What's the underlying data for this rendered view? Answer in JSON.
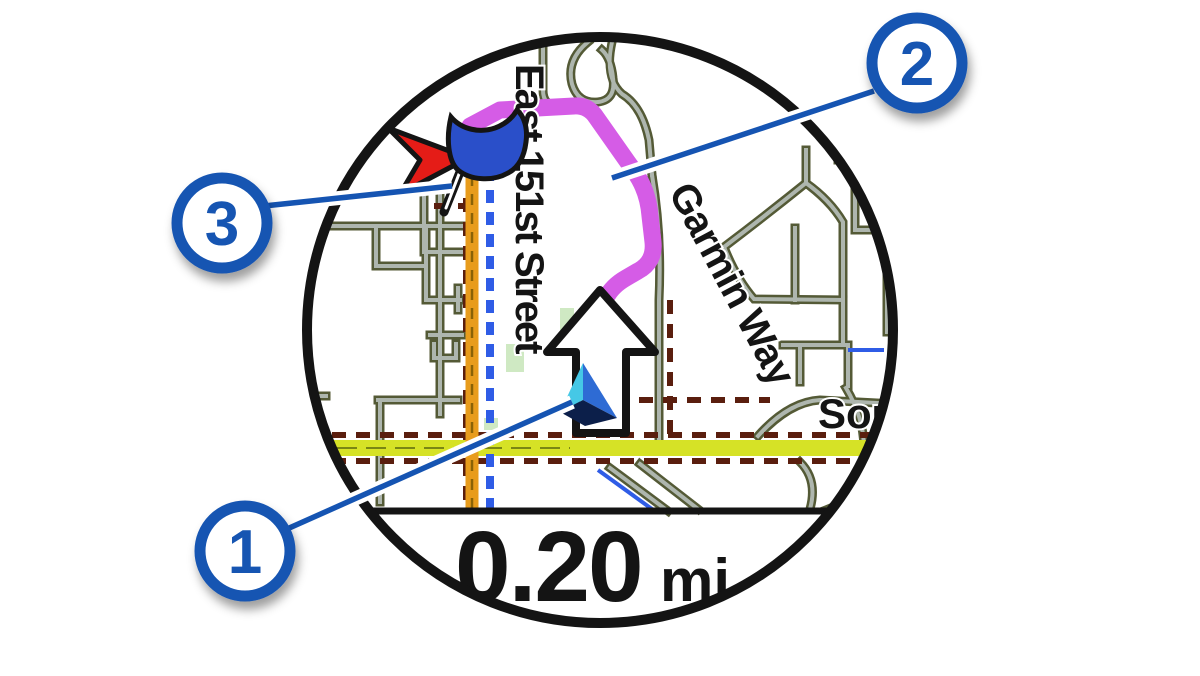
{
  "figure": {
    "type": "watch-navigation-map-callout-diagram",
    "description": "Round watch screen showing turn-by-turn map navigation with three numbered callouts"
  },
  "map": {
    "street_labels": {
      "vertical": "East 151st Street",
      "diagonal": "Garmin Way",
      "partial_right": "Sout"
    },
    "scale": {
      "value": "0.20",
      "unit": "mi"
    }
  },
  "callouts": [
    {
      "number": "1",
      "target": "current-position-marker"
    },
    {
      "number": "2",
      "target": "route-line"
    },
    {
      "number": "3",
      "target": "destination-marker"
    }
  ],
  "icons": {
    "c1_target": "position-triangle-icon",
    "c2_target": "route-magenta-line",
    "c3_target": "destination-flag-icon",
    "nav_arrow": "straight-ahead-arrow-icon",
    "pointer": "red-direction-arrow-icon"
  },
  "colors": {
    "callout_blue": "#1554b2",
    "route_magenta": "#d55ce6",
    "highway_orange": "#e89c1c",
    "road_yellow": "#d6e226",
    "road_casing_olive": "#545a36",
    "road_fill_gray": "#aeb6ae",
    "dash_maroon": "#5a1e0e",
    "track_blue": "#2f5ce6",
    "destination_red": "#e51c17",
    "flag_blue": "#2a4fc9",
    "position_cyan": "#45c8e6",
    "position_blue": "#2e6bd4",
    "position_dark": "#0c1f4a",
    "watch_ring": "#141414"
  }
}
